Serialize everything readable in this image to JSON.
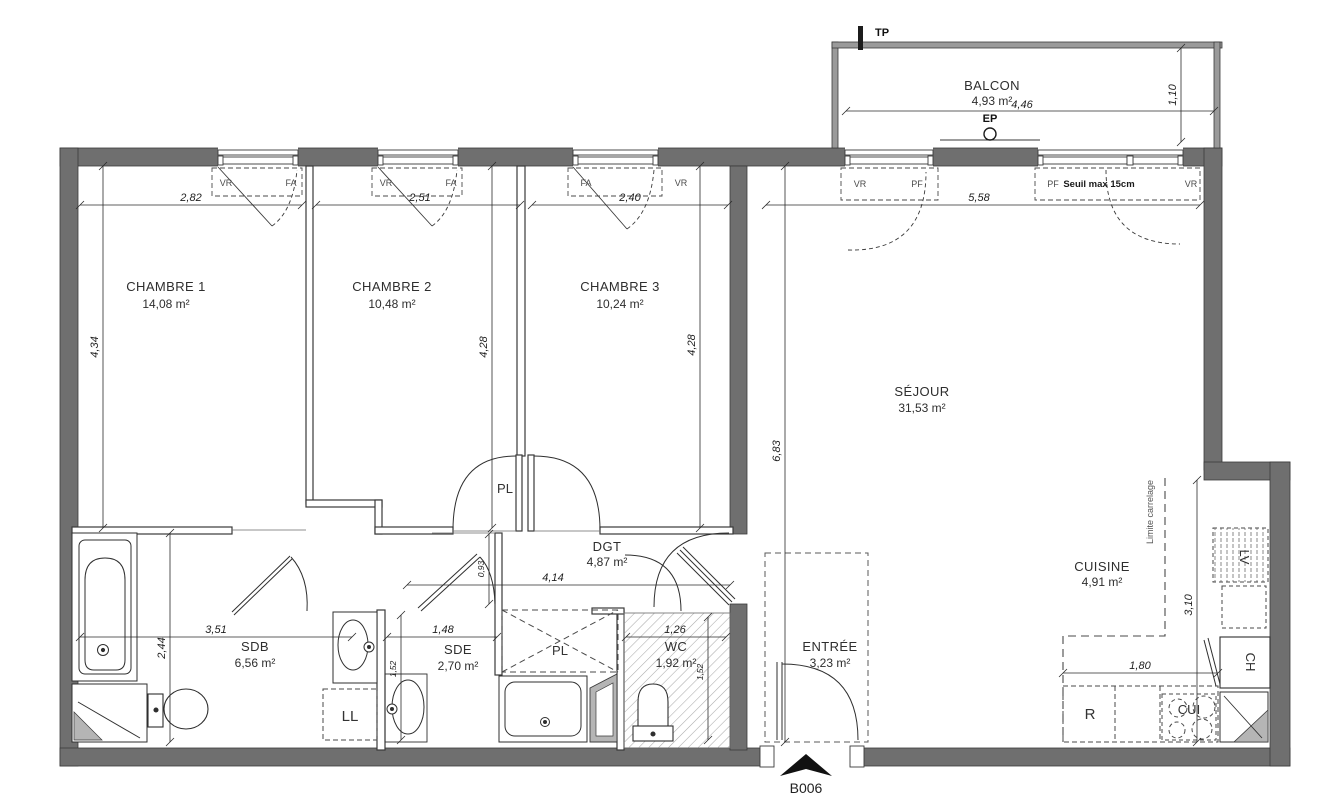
{
  "unit": {
    "code": "B006"
  },
  "rooms": {
    "chambre1": {
      "name": "CHAMBRE 1",
      "area": "14,08 m²"
    },
    "chambre2": {
      "name": "CHAMBRE 2",
      "area": "10,48 m²"
    },
    "chambre3": {
      "name": "CHAMBRE 3",
      "area": "10,24 m²"
    },
    "sejour": {
      "name": "SÉJOUR",
      "area": "31,53 m²"
    },
    "cuisine": {
      "name": "CUISINE",
      "area": "4,91 m²"
    },
    "balcon": {
      "name": "BALCON",
      "area": "4,93 m²"
    },
    "dgt": {
      "name": "DGT",
      "area": "4,87 m²"
    },
    "sdb": {
      "name": "SDB",
      "area": "6,56 m²"
    },
    "sde": {
      "name": "SDE",
      "area": "2,70 m²"
    },
    "wc": {
      "name": "WC",
      "area": "1,92 m²"
    },
    "entree": {
      "name": "ENTRÉE",
      "area": "3,23 m²"
    }
  },
  "dims": {
    "ch1_w": "2,82",
    "ch1_d": "4,34",
    "ch2_w": "2,51",
    "ch2_d": "4,28",
    "ch3_w": "2,40",
    "ch3_d": "4,28",
    "sejour_w": "5,58",
    "sejour_d": "6,83",
    "balcon_w": "4,46",
    "balcon_d": "1,10",
    "sdb_w": "3,51",
    "sdb_d": "2,44",
    "sde_w": "1,48",
    "sde_d": "1,52",
    "wc_w": "1,26",
    "wc_d": "1,52",
    "dgt_w": "4,14",
    "dgt_d": "0,93",
    "cuisine_w": "1,80",
    "cuisine_d": "3,10"
  },
  "windows": {
    "w1": {
      "left": "VR",
      "right": "FA"
    },
    "w2": {
      "left": "VR",
      "right": "FA"
    },
    "w3": {
      "left": "FA",
      "right": "VR"
    },
    "w4": {
      "left": "VR",
      "right": "PF"
    },
    "w5": {
      "left": "PF",
      "right": "VR",
      "note": "Seuil max 15cm"
    }
  },
  "fixtures": {
    "washing_machine": "LL",
    "closet_hallway": "PL",
    "closet_bedrooms": "PL",
    "fridge": "R",
    "hob": "CUI",
    "water_heater": "CH",
    "dishwasher": "LV"
  },
  "annotations": {
    "duct": "TP",
    "downpipe": "EP",
    "tile_limit": "Limite carrelage"
  },
  "colors": {
    "wall": "#6f6f6f",
    "line": "#3a3a3a",
    "poche": "#b5b5b5",
    "balcony_wall": "#9a9a9a"
  }
}
